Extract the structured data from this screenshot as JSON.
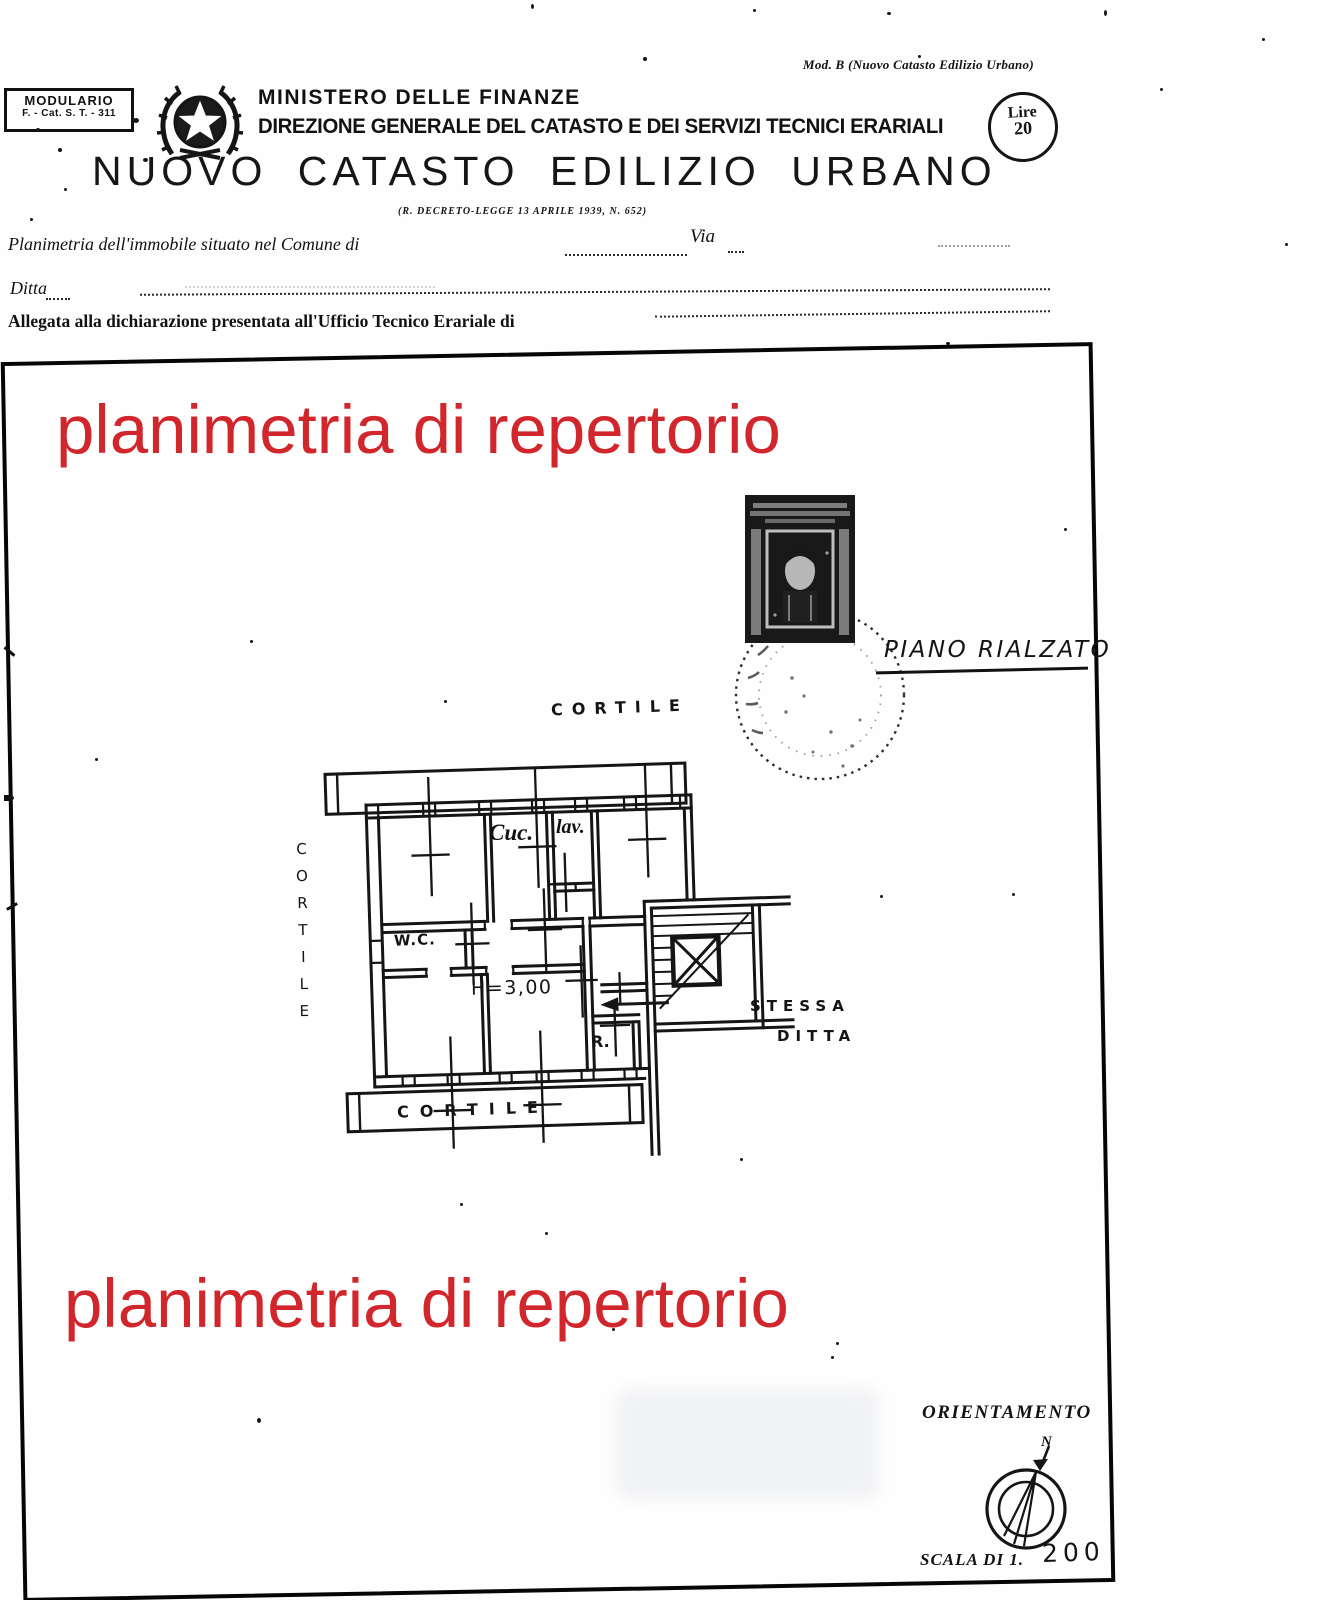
{
  "header": {
    "modulario_line1": "MODULARIO",
    "modulario_line2": "F. - Cat. S. T. - 311",
    "mod_note": "Mod. B (Nuovo Catasto Edilizio Urbano)",
    "ministry": "MINISTERO DELLE FINANZE",
    "directorate": "DIREZIONE GENERALE DEL CATASTO E DEI SERVIZI TECNICI ERARIALI",
    "title": "NUOVO CATASTO EDILIZIO URBANO",
    "decree": "(R. DECRETO-LEGGE 13 APRILE 1939, N. 652)",
    "fee_label": "Lire",
    "fee_value": "20"
  },
  "form": {
    "line1": "Planimetria dell'immobile situato nel Comune di",
    "via": "Via",
    "line2": "Ditta",
    "line3": "Allegata alla dichiarazione presentata all'Ufficio Tecnico Erariale di"
  },
  "watermark": {
    "text": "planimetria di repertorio",
    "color": "#d0262c"
  },
  "plan": {
    "floor_label": "PIANO RIALZATO",
    "courtyard_top": "CORTILE",
    "courtyard_left": "CORTILE",
    "courtyard_bottom": "CORTILE",
    "kitchen": "Cuc.",
    "laundry": "lav.",
    "wc": "W.C.",
    "height": "H=3,00",
    "storage": "R.",
    "neighbor_line1": "STESSA",
    "neighbor_line2": "DITTA"
  },
  "footer": {
    "orientation": "ORIENTAMENTO",
    "north": "N",
    "scale_label": "SCALA DI 1.",
    "scale_value": "200"
  }
}
